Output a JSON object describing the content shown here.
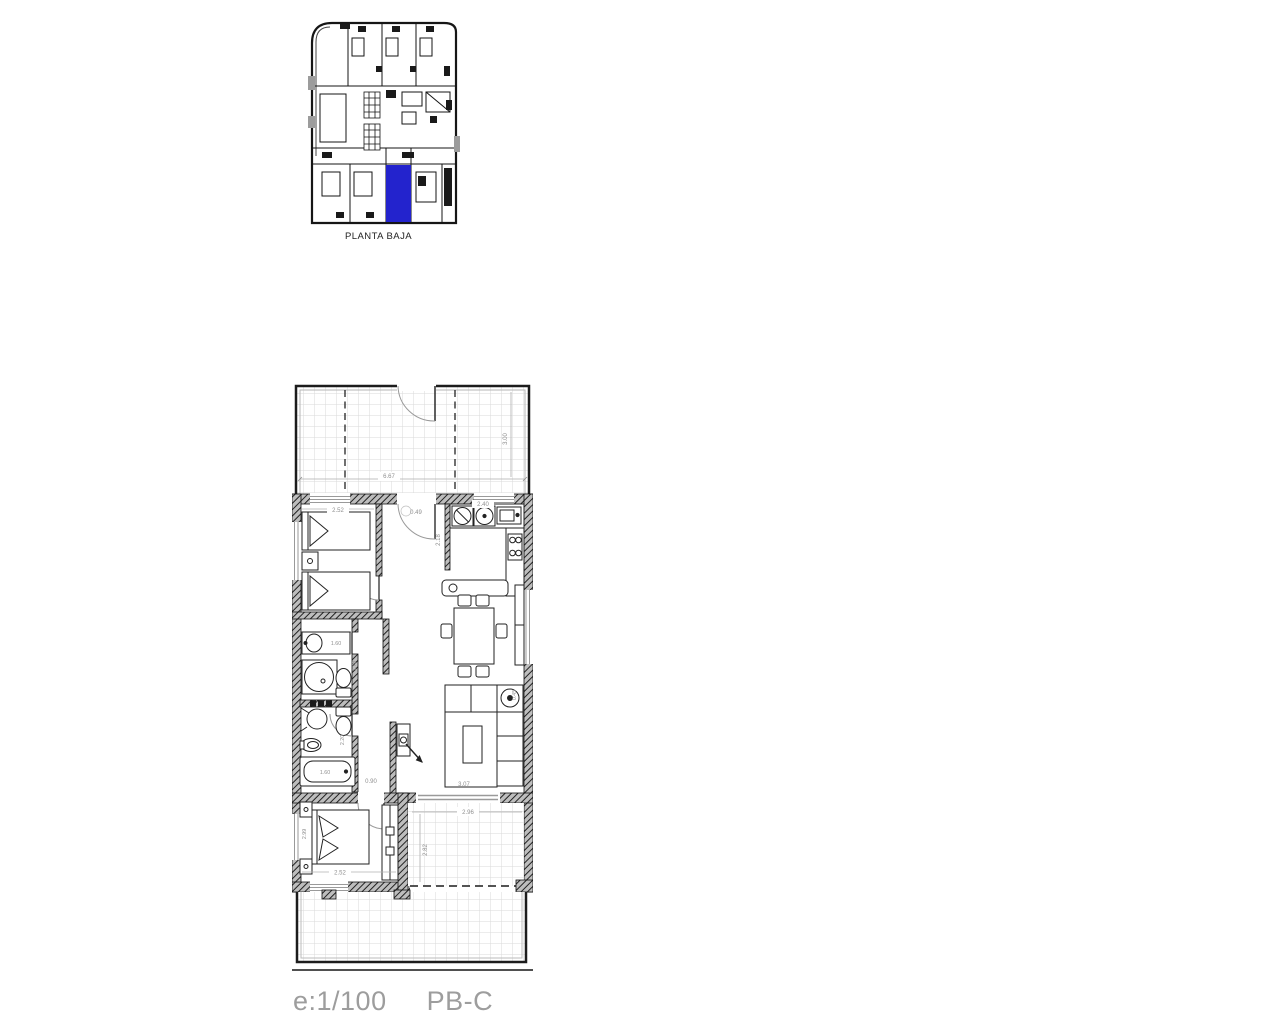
{
  "site_plan": {
    "label": "PLANTA BAJA",
    "highlight_color": "#2323cd"
  },
  "floor_plan": {
    "dimensions": {
      "terrace_width": "6.67",
      "terrace_depth": "3.00",
      "bedroom1_width": "2.52",
      "entry": "0.49",
      "kitchen_width": "2.40",
      "kitchen_depth": "2.18",
      "bath1_vanity": "1.60",
      "bath1_depth": "1.78",
      "bath2_depth": "2.20",
      "bathtub": "1.60",
      "hall_width": "0.90",
      "living_length": "3.07",
      "side_table": "0.45",
      "bedroom2_width": "2.52",
      "bedroom2_depth": "2.99",
      "terrace2_width": "2.96",
      "terrace2_depth": "2.82"
    }
  },
  "caption": {
    "scale": "e:1/100",
    "unit": "PB-C"
  }
}
